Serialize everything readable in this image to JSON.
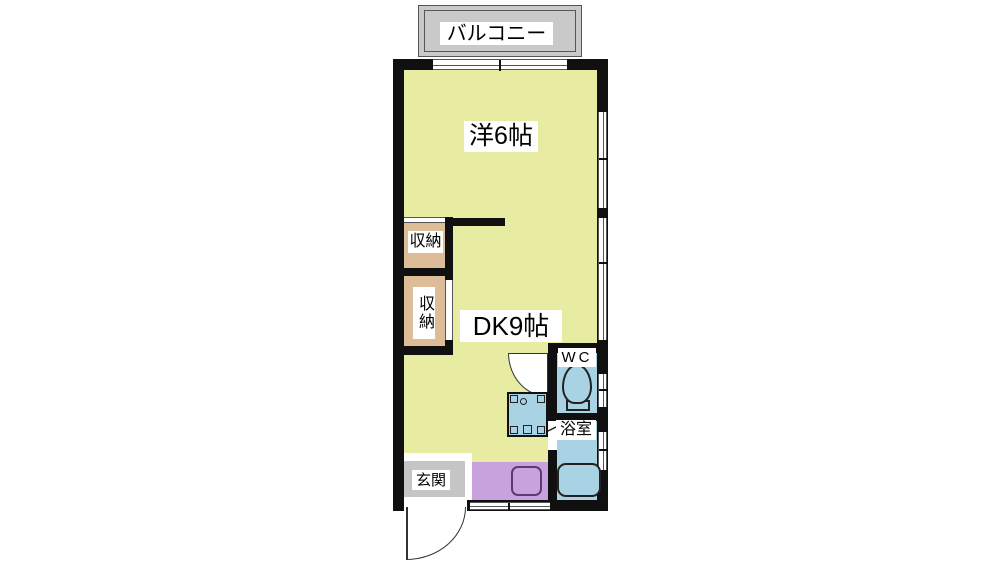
{
  "title": "1DK間取り図",
  "colors": {
    "room_yellow": "#e8eca2",
    "closet_tan": "#dcbd98",
    "wet_blue": "#a9d2e4",
    "kitchen_purple": "#c7a2dd",
    "balcony_gray": "#c9c9c9",
    "entrance_gray": "#c5c5c5",
    "wall_black": "#101010",
    "outline_dark": "#222222"
  },
  "balcony": {
    "label": "バルコニー"
  },
  "rooms": {
    "western": {
      "label": "洋6帖"
    },
    "dk": {
      "label": "DK9帖"
    },
    "closet_upper": {
      "label": "収納"
    },
    "closet_lower": {
      "label": "収納"
    },
    "wc": {
      "label": "WC"
    },
    "bath": {
      "label": "浴室"
    },
    "entrance": {
      "label": "玄関"
    }
  },
  "fixtures": {
    "toilet": "toilet-icon",
    "bathtub": "bathtub-icon",
    "kitchen_sink": "kitchen-sink-icon",
    "washbasin": "washbasin-icon",
    "entrance_door": "entrance-door-swing-icon",
    "washroom_door": "washroom-door-swing-icon",
    "bath_door": "bath-door-line-icon"
  }
}
